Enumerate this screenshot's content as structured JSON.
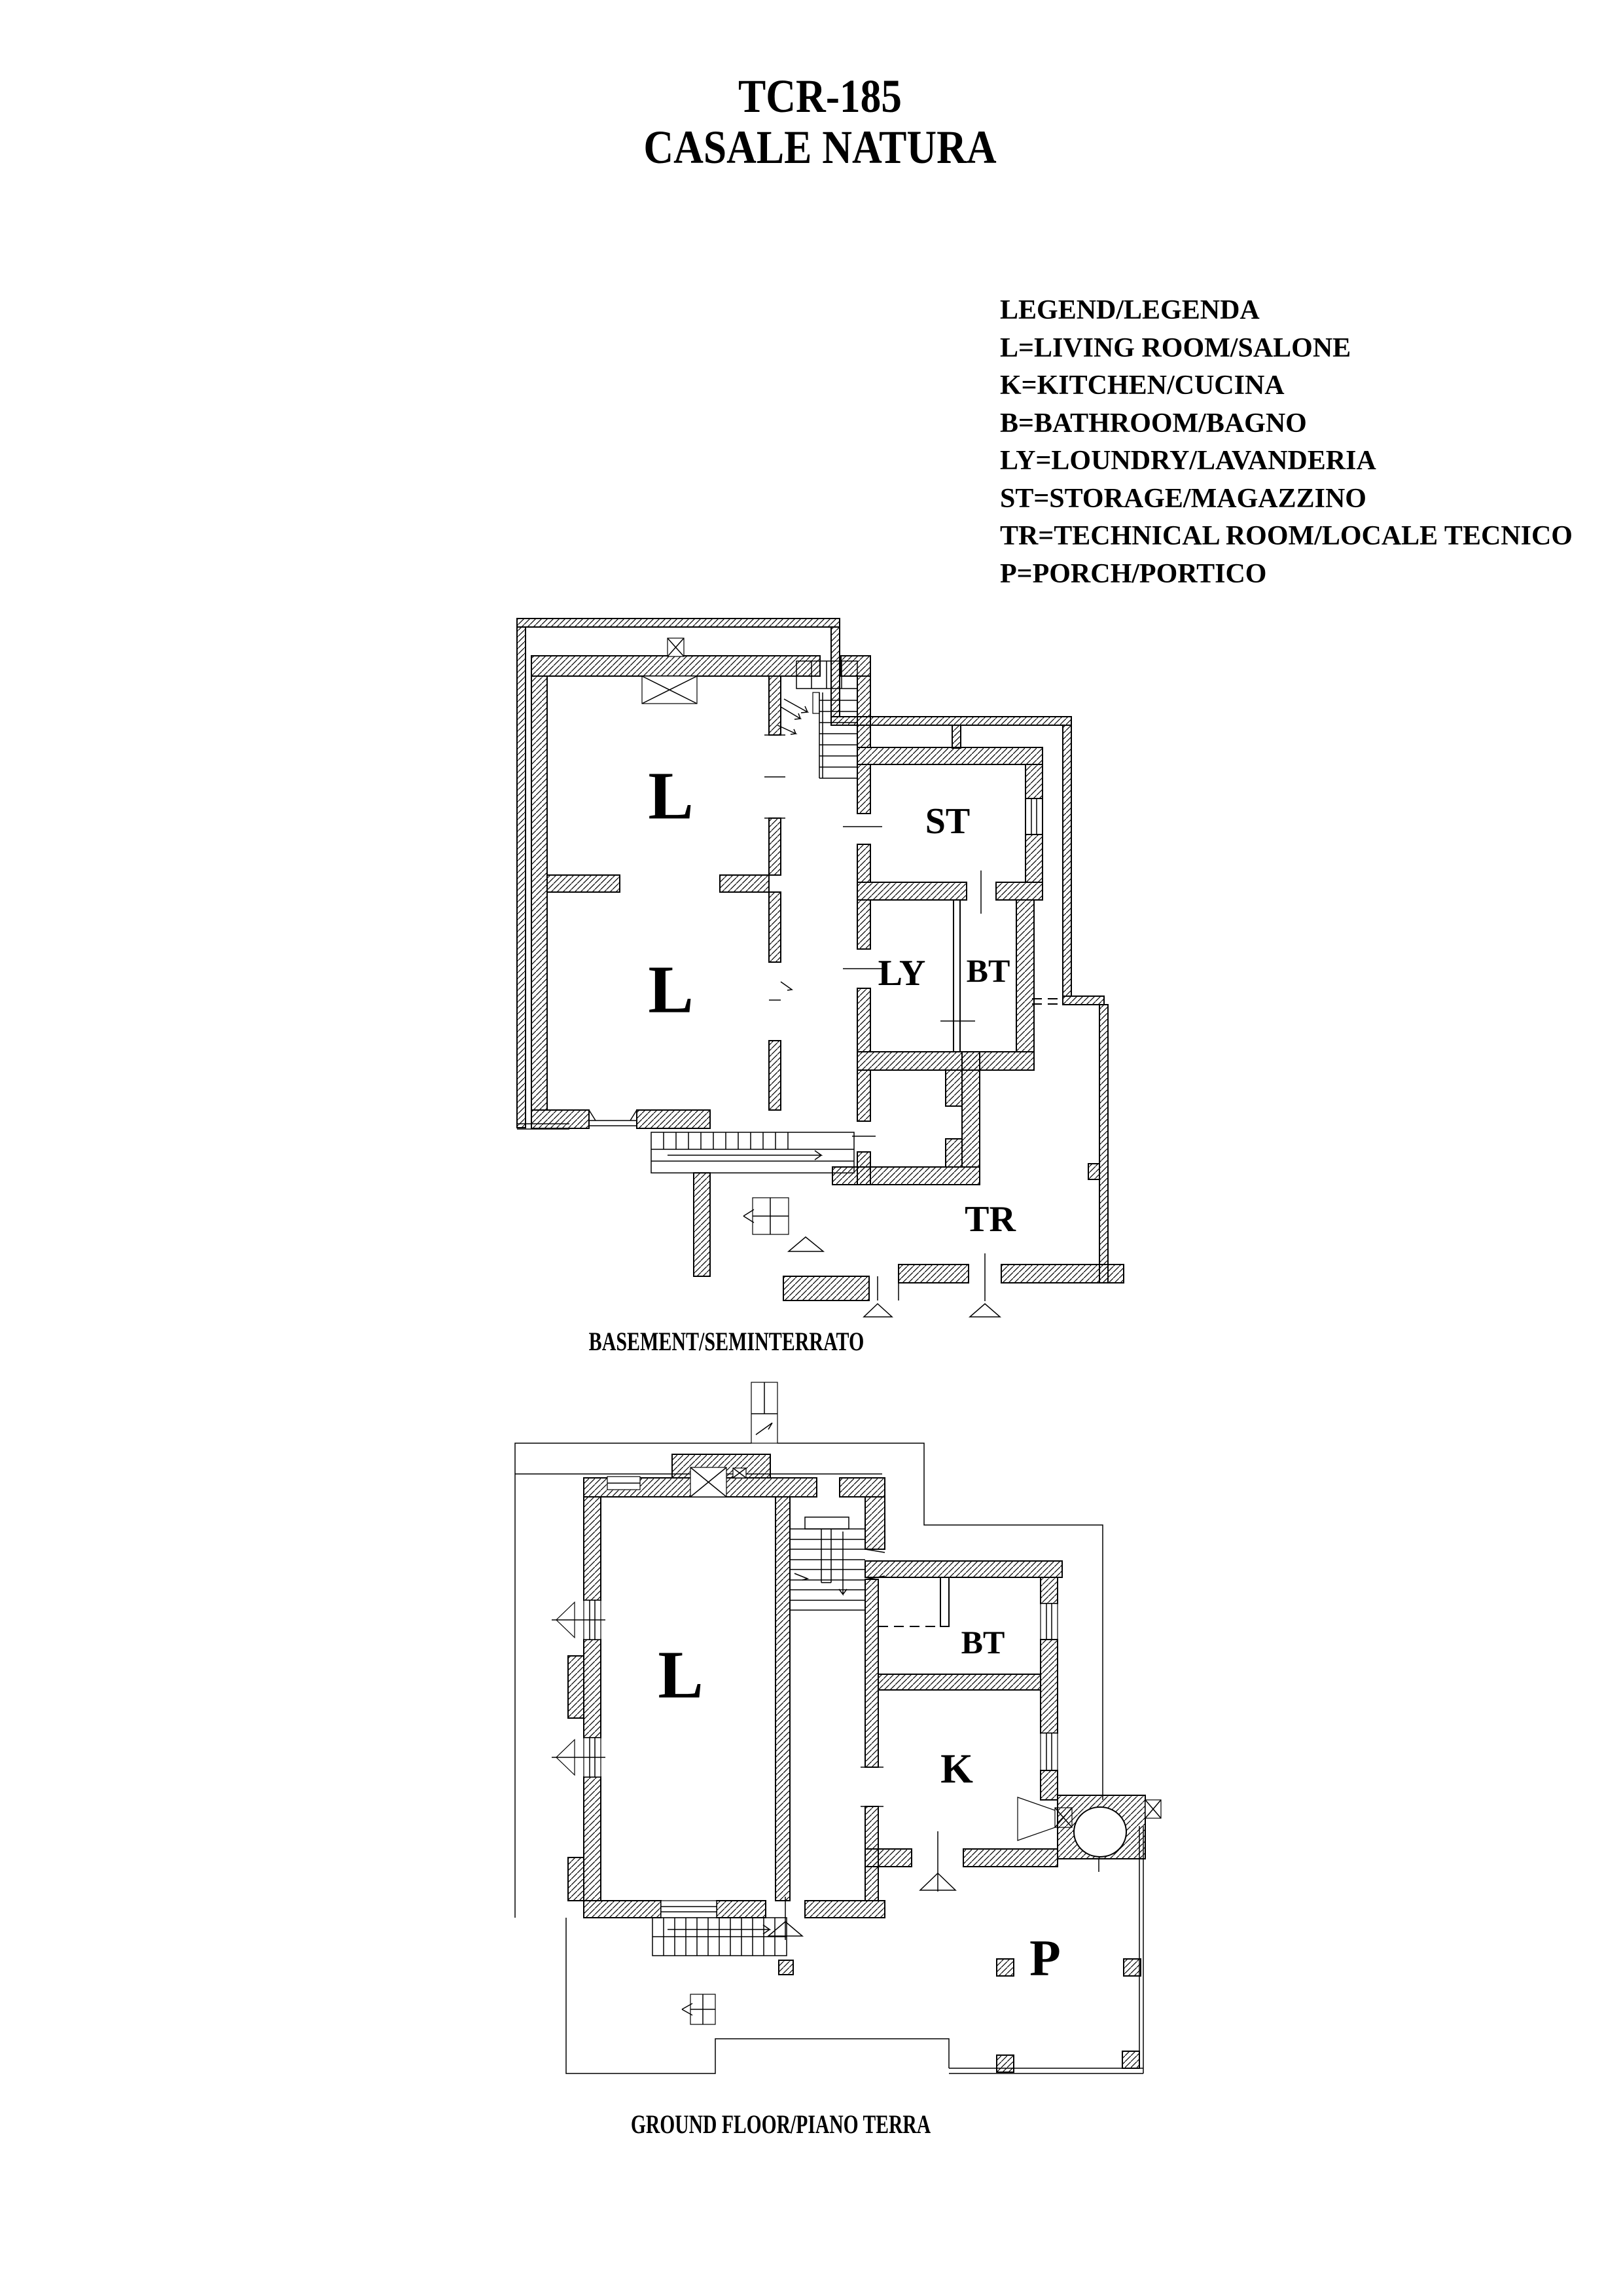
{
  "colors": {
    "paper": "#ffffff",
    "ink": "#000000"
  },
  "title": {
    "line1": "TCR-185",
    "line2": "CASALE NATURA"
  },
  "legend": {
    "lines": [
      "LEGEND/LEGENDA",
      "L=LIVING ROOM/SALONE",
      "K=KITCHEN/CUCINA",
      "B=BATHROOM/BAGNO",
      "LY=LOUNDRY/LAVANDERIA",
      "ST=STORAGE/MAGAZZINO",
      "TR=TECHNICAL ROOM/LOCALE TECNICO",
      "P=PORCH/PORTICO"
    ]
  },
  "basement": {
    "caption": "BASEMENT/SEMINTERRATO",
    "rooms": {
      "l_upper": "L",
      "l_lower": "L",
      "st": "ST",
      "ly": "LY",
      "bt": "BT",
      "tr": "TR"
    }
  },
  "ground": {
    "caption": "GROUND FLOOR/PIANO TERRA",
    "rooms": {
      "l": "L",
      "bt": "BT",
      "k": "K",
      "p": "P"
    }
  }
}
